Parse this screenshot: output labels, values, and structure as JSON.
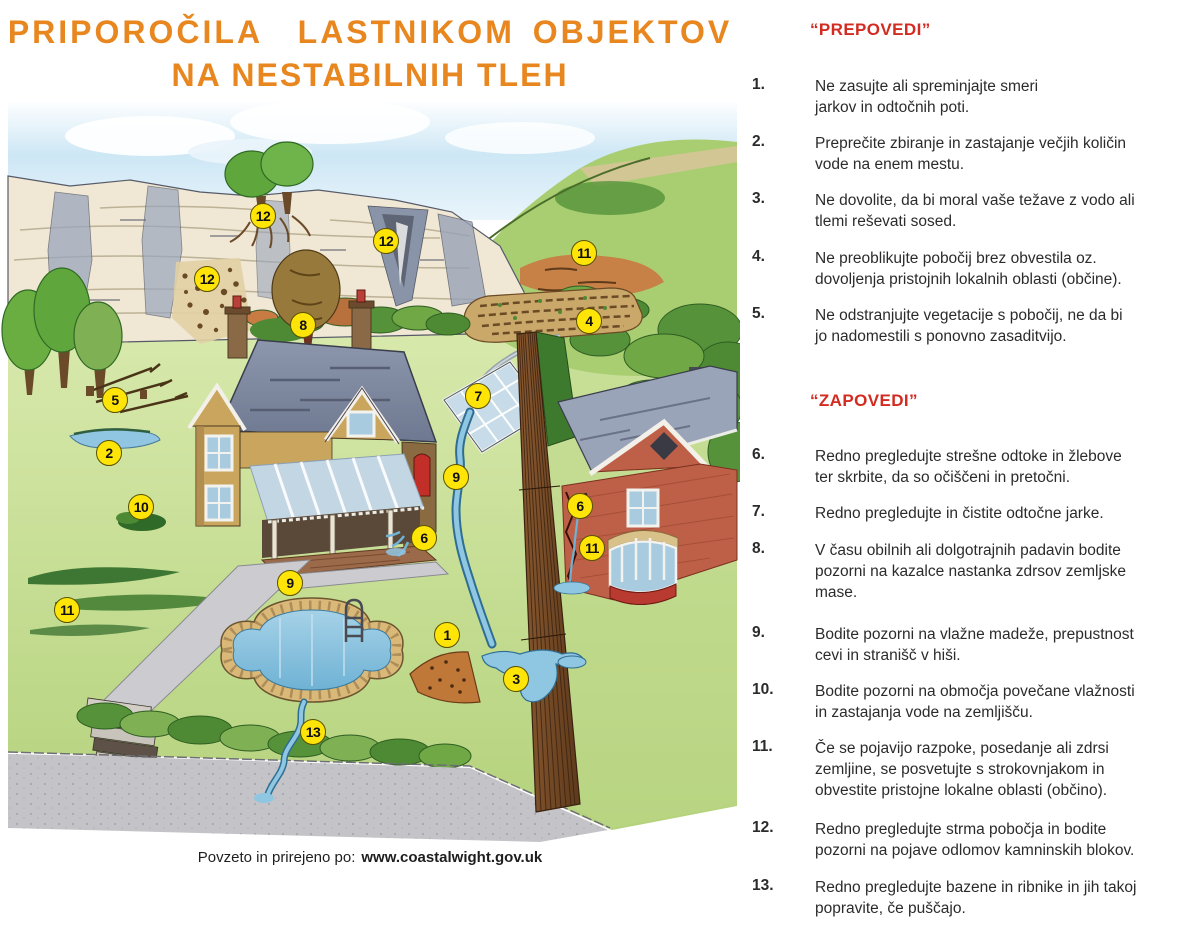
{
  "poster": {
    "title_line1": "PRIPOROČILA  LASTNIKOM OBJEKTOV",
    "title_line2": "NA NESTABILNIH TLEH",
    "colors": {
      "title_orange": "#E8871F",
      "heading_red": "#D32B21",
      "marker_yellow": "#FFE408"
    },
    "attribution_prefix": "Povzeto in prirejeno po:",
    "attribution_url": "www.coastalwight.gov.uk"
  },
  "sections": [
    {
      "heading": "“PREPOVEDI”",
      "items": [
        {
          "num": "1.",
          "text": "Ne zasujte ali spreminjajte smeri\njarkov in odtočnih poti."
        },
        {
          "num": "2.",
          "text": "Preprečite zbiranje in zastajanje večjih količin\nvode na enem mestu."
        },
        {
          "num": "3.",
          "text": "Ne dovolite, da bi moral vaše težave z vodo ali\ntlemi reševati sosed."
        },
        {
          "num": "4.",
          "text": "Ne preoblikujte pobočij brez obvestila oz.\ndovoljenja pristojnih lokalnih oblasti (občine)."
        },
        {
          "num": "5.",
          "text": "Ne odstranjujte vegetacije s pobočij, ne da bi\njo nadomestili s ponovno zasaditvijo."
        }
      ]
    },
    {
      "heading": "“ZAPOVEDI”",
      "items": [
        {
          "num": "6.",
          "text": "Redno pregledujte strešne odtoke in žlebove\nter skrbite, da so očiščeni in pretočni."
        },
        {
          "num": "7.",
          "text": "Redno pregledujte in čistite odtočne jarke."
        },
        {
          "num": "8.",
          "text": "V času obilnih ali dolgotrajnih padavin bodite\npozorni na kazalce nastanka zdrsov zemljske\nmase."
        },
        {
          "num": "9.",
          "text": "Bodite pozorni na vlažne madeže, prepustnost\ncevi in stranišč v hiši."
        },
        {
          "num": "10.",
          "text": "Bodite pozorni na območja povečane vlažnosti\nin zastajanja vode na zemljišču."
        },
        {
          "num": "11.",
          "text": "Če se pojavijo razpoke, posedanje ali zdrsi\nzemljine, se posvetujte s strokovnjakom in\nobvestite pristojne lokalne oblasti (občino)."
        },
        {
          "num": "12.",
          "text": "Redno pregledujte strma pobočja in bodite\npozorni na pojave odlomov kamninskih blokov."
        },
        {
          "num": "13.",
          "text": "Redno pregledujte bazene in ribnike in jih takoj\npopravite, če puščajo."
        }
      ]
    }
  ],
  "illustration": {
    "markers": [
      {
        "n": "12",
        "x": 263,
        "y": 216
      },
      {
        "n": "12",
        "x": 386,
        "y": 241
      },
      {
        "n": "12",
        "x": 207,
        "y": 279
      },
      {
        "n": "11",
        "x": 584,
        "y": 253
      },
      {
        "n": "8",
        "x": 303,
        "y": 325
      },
      {
        "n": "4",
        "x": 589,
        "y": 321
      },
      {
        "n": "5",
        "x": 115,
        "y": 400
      },
      {
        "n": "7",
        "x": 478,
        "y": 396
      },
      {
        "n": "2",
        "x": 109,
        "y": 453
      },
      {
        "n": "9",
        "x": 456,
        "y": 477
      },
      {
        "n": "10",
        "x": 141,
        "y": 507
      },
      {
        "n": "6",
        "x": 580,
        "y": 506
      },
      {
        "n": "6",
        "x": 424,
        "y": 538
      },
      {
        "n": "11",
        "x": 592,
        "y": 548
      },
      {
        "n": "9",
        "x": 290,
        "y": 583
      },
      {
        "n": "11",
        "x": 67,
        "y": 610
      },
      {
        "n": "1",
        "x": 447,
        "y": 635
      },
      {
        "n": "3",
        "x": 516,
        "y": 679
      },
      {
        "n": "13",
        "x": 313,
        "y": 732
      }
    ]
  }
}
